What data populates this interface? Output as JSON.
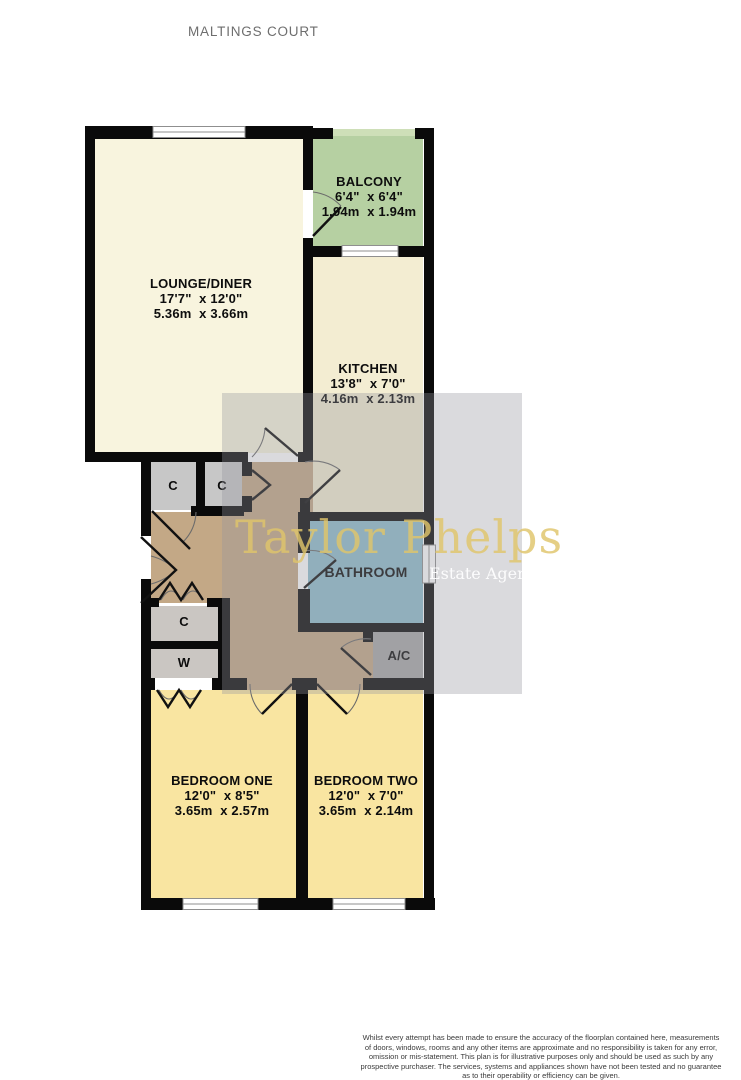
{
  "title": "MALTINGS COURT",
  "colors": {
    "wall": "#0a0a0a",
    "lounge": "#F8F4DE",
    "kitchen": "#F3EDD2",
    "balcony": "#B6D0A2",
    "balcony_railing": "#CEDFB8",
    "bedroom": "#F9E5A1",
    "bathroom": "#90BDCC",
    "hallway": "#C3A886",
    "closet_top": "#C7C7C7",
    "closet_lower": "#CAC6C2",
    "ac_closet": "#A8A8A8",
    "window": "#ffffff",
    "watermark_text": "#DFC46A"
  },
  "rooms": {
    "lounge": {
      "name": "LOUNGE/DINER",
      "imperial": "17'7\"  x 12'0\"",
      "metric": "5.36m  x 3.66m"
    },
    "balcony": {
      "name": "BALCONY",
      "imperial": "6'4\"  x 6'4\"",
      "metric": "1.94m  x 1.94m"
    },
    "kitchen": {
      "name": "KITCHEN",
      "imperial": "13'8\"  x 7'0\"",
      "metric": "4.16m  x 2.13m"
    },
    "bathroom": {
      "name": "BATHROOM"
    },
    "bedroom_one": {
      "name": "BEDROOM ONE",
      "imperial": "12'0\"  x 8'5\"",
      "metric": "3.65m  x 2.57m"
    },
    "bedroom_two": {
      "name": "BEDROOM TWO",
      "imperial": "12'0\"  x 7'0\"",
      "metric": "3.65m  x 2.14m"
    },
    "closet_one": {
      "name": "C"
    },
    "closet_two": {
      "name": "C"
    },
    "closet_three": {
      "name": "C"
    },
    "wardrobe": {
      "name": "W"
    },
    "airing_cupboard": {
      "name": "A/C"
    }
  },
  "watermark": {
    "brand": "Taylor Phelps",
    "tagline": "Estate Agency"
  },
  "footer": {
    "lines": [
      "Whilst every attempt has been made to ensure the accuracy of the floorplan contained here, measurements",
      "of doors, windows, rooms and any other items are approximate and no responsibility is taken for any error,",
      "omission or mis-statement. This plan is for illustrative purposes only and should be used as such by any",
      "prospective purchaser. The services, systems and appliances shown have not been tested and no guarantee",
      "as to their operability or efficiency can be given.",
      "Made with Metropix ©2023"
    ]
  }
}
